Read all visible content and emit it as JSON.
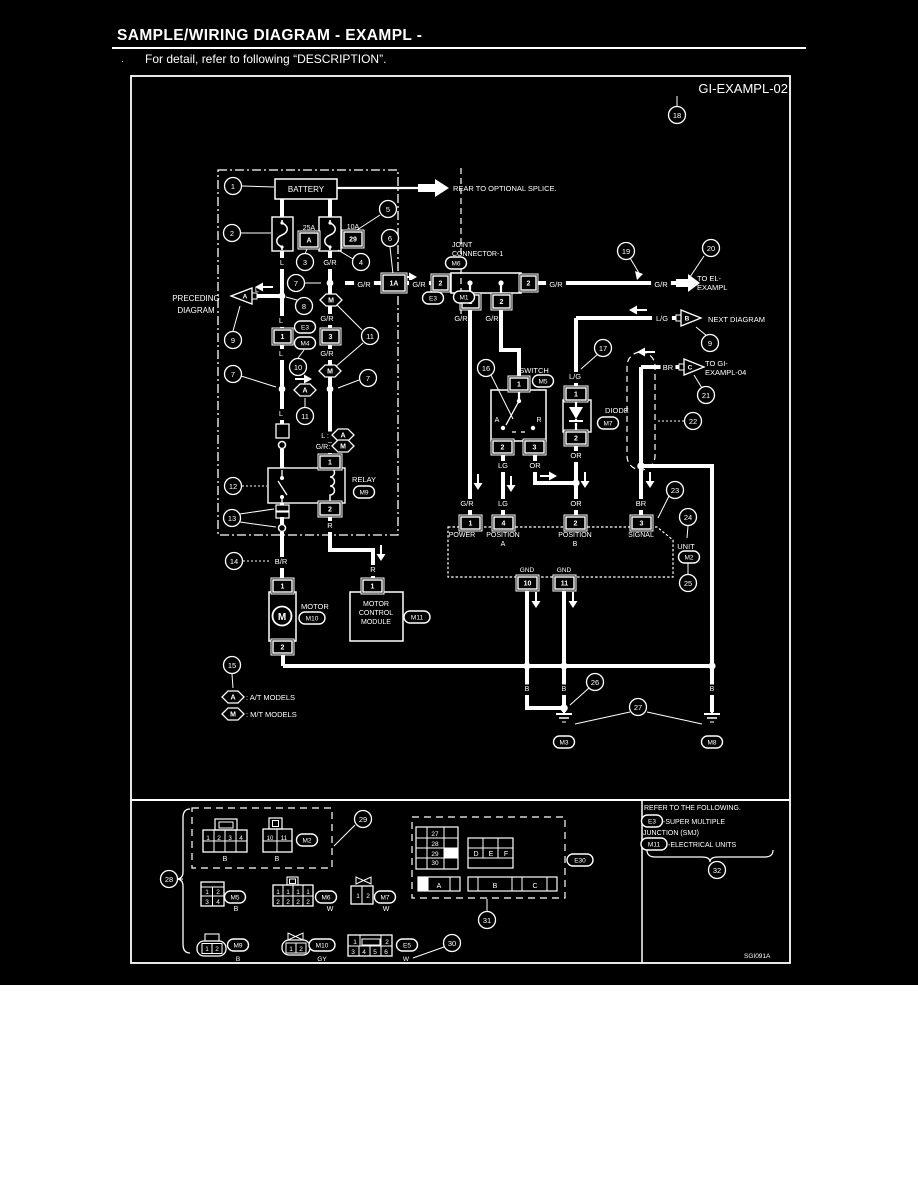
{
  "page": {
    "title": "SAMPLE/WIRING DIAGRAM - EXAMPL -",
    "bullet": "·",
    "subtitle": "For detail, refer to following “DESCRIPTION”.",
    "diagram_code": "GI-EXAMPL-02",
    "figure_code": "SGI091A"
  },
  "colors": {
    "background": "#000000",
    "foreground": "#ffffff"
  },
  "diagram": {
    "texts": [
      {
        "x": 788,
        "y": 93,
        "t": "GI-EXAMPL-02",
        "s": 13,
        "a": "e"
      },
      {
        "x": 306,
        "y": 192,
        "t": "BATTERY",
        "s": 8
      },
      {
        "x": 453,
        "y": 191,
        "t": "REAR TO OPTIONAL SPLICE.",
        "s": 7.5,
        "a": "s"
      },
      {
        "x": 309,
        "y": 230,
        "t": "25A",
        "s": 7
      },
      {
        "x": 353,
        "y": 229,
        "t": "10A",
        "s": 7
      },
      {
        "x": 282,
        "y": 265,
        "t": "L",
        "s": 7.5,
        "b": 1
      },
      {
        "x": 330,
        "y": 265,
        "t": "G/R",
        "s": 7.5,
        "b": 1
      },
      {
        "x": 364,
        "y": 287,
        "t": "G/R",
        "s": 7.5,
        "b": 1
      },
      {
        "x": 419,
        "y": 287,
        "t": "G/R",
        "s": 7.5,
        "b": 1
      },
      {
        "x": 556,
        "y": 287,
        "t": "G/R",
        "s": 7.5,
        "b": 1
      },
      {
        "x": 661,
        "y": 287,
        "t": "G/R",
        "s": 7.5,
        "b": 1
      },
      {
        "x": 257,
        "y": 292,
        "t": "L",
        "s": 7.5
      },
      {
        "x": 196,
        "y": 301,
        "t": "PRECEDING",
        "s": 8
      },
      {
        "x": 196,
        "y": 313,
        "t": "DIAGRAM",
        "s": 8
      },
      {
        "x": 452,
        "y": 247,
        "t": "JOINT",
        "s": 7,
        "a": "s"
      },
      {
        "x": 452,
        "y": 256,
        "t": "CONNECTOR-1",
        "s": 7,
        "a": "s"
      },
      {
        "x": 281,
        "y": 323,
        "t": "L",
        "s": 7.5,
        "b": 1
      },
      {
        "x": 327,
        "y": 321,
        "t": "G/R",
        "s": 7.5,
        "b": 1
      },
      {
        "x": 281,
        "y": 356,
        "t": "L",
        "s": 7.5,
        "b": 1
      },
      {
        "x": 327,
        "y": 356,
        "t": "G/R",
        "s": 7.5,
        "b": 1
      },
      {
        "x": 281,
        "y": 416,
        "t": "L",
        "s": 7.5,
        "b": 1
      },
      {
        "x": 461,
        "y": 321,
        "t": "G/R",
        "s": 7.5
      },
      {
        "x": 492,
        "y": 321,
        "t": "G/R",
        "s": 7.5
      },
      {
        "x": 534,
        "y": 373,
        "t": "SWITCH",
        "s": 7.5
      },
      {
        "x": 497,
        "y": 422,
        "t": "A",
        "s": 7
      },
      {
        "x": 539,
        "y": 422,
        "t": "R",
        "s": 7
      },
      {
        "x": 503,
        "y": 468,
        "t": "LG",
        "s": 7.5,
        "b": 1
      },
      {
        "x": 535,
        "y": 468,
        "t": "OR",
        "s": 7.5,
        "b": 1
      },
      {
        "x": 575,
        "y": 379,
        "t": "L/G",
        "s": 7.5,
        "b": 1
      },
      {
        "x": 605,
        "y": 413,
        "t": "DIODE",
        "s": 7.5,
        "a": "s"
      },
      {
        "x": 576,
        "y": 458,
        "t": "OR",
        "s": 7.5,
        "b": 1
      },
      {
        "x": 467,
        "y": 506,
        "t": "G/R",
        "s": 7.5,
        "b": 1
      },
      {
        "x": 503,
        "y": 506,
        "t": "LG",
        "s": 7.5,
        "b": 1
      },
      {
        "x": 576,
        "y": 506,
        "t": "OR",
        "s": 7.5,
        "b": 1
      },
      {
        "x": 641,
        "y": 506,
        "t": "BR",
        "s": 7.5,
        "b": 1
      },
      {
        "x": 662,
        "y": 321,
        "t": "L/G",
        "s": 7.5,
        "b": 1
      },
      {
        "x": 668,
        "y": 370,
        "t": "BR",
        "s": 7.5,
        "b": 1
      },
      {
        "x": 708,
        "y": 322,
        "t": "NEXT DIAGRAM",
        "s": 7.5,
        "a": "s"
      },
      {
        "x": 697,
        "y": 281,
        "t": "TO EL-",
        "s": 7.5,
        "a": "s"
      },
      {
        "x": 697,
        "y": 290,
        "t": "EXAMPL",
        "s": 7.5,
        "a": "s"
      },
      {
        "x": 705,
        "y": 366,
        "t": "TO GI-",
        "s": 7.5,
        "a": "s"
      },
      {
        "x": 705,
        "y": 375,
        "t": "EXAMPL-04",
        "s": 7.5,
        "a": "s"
      },
      {
        "x": 462,
        "y": 537,
        "t": "POWER",
        "s": 7
      },
      {
        "x": 503,
        "y": 537,
        "t": "POSITION",
        "s": 7
      },
      {
        "x": 503,
        "y": 546,
        "t": "A",
        "s": 7
      },
      {
        "x": 575,
        "y": 537,
        "t": "POSITION",
        "s": 7
      },
      {
        "x": 575,
        "y": 546,
        "t": "B",
        "s": 7
      },
      {
        "x": 641,
        "y": 537,
        "t": "SIGNAL",
        "s": 7
      },
      {
        "x": 527,
        "y": 572,
        "t": "GND",
        "s": 6.5
      },
      {
        "x": 564,
        "y": 572,
        "t": "GND",
        "s": 6.5
      },
      {
        "x": 686,
        "y": 549,
        "t": "UNIT",
        "s": 7.5
      },
      {
        "x": 352,
        "y": 482,
        "t": "RELAY",
        "s": 7.5,
        "a": "s"
      },
      {
        "x": 325,
        "y": 438,
        "t": "L :",
        "s": 7,
        "b": 1
      },
      {
        "x": 323,
        "y": 449,
        "t": "G/R:",
        "s": 7,
        "b": 1
      },
      {
        "x": 330,
        "y": 528,
        "t": "R",
        "s": 7.5,
        "b": 1
      },
      {
        "x": 373,
        "y": 572,
        "t": "R",
        "s": 7.5,
        "b": 1
      },
      {
        "x": 281,
        "y": 564,
        "t": "B/R",
        "s": 7.5,
        "b": 1
      },
      {
        "x": 301,
        "y": 609,
        "t": "MOTOR",
        "s": 7.5,
        "a": "s"
      },
      {
        "x": 376,
        "y": 606,
        "t": "MOTOR",
        "s": 7
      },
      {
        "x": 376,
        "y": 615,
        "t": "CONTROL",
        "s": 7
      },
      {
        "x": 376,
        "y": 624,
        "t": "MODULE",
        "s": 7
      },
      {
        "x": 246,
        "y": 700,
        "t": ": A/T MODELS",
        "s": 7.5,
        "a": "s"
      },
      {
        "x": 246,
        "y": 717,
        "t": ": M/T MODELS",
        "s": 7.5,
        "a": "s"
      },
      {
        "x": 527,
        "y": 691,
        "t": "B",
        "s": 7,
        "b": 1
      },
      {
        "x": 564,
        "y": 691,
        "t": "B",
        "s": 7,
        "b": 1
      },
      {
        "x": 712,
        "y": 691,
        "t": "B",
        "s": 7,
        "b": 1
      },
      {
        "x": 644,
        "y": 810,
        "t": "REFER TO THE FOLLOWING.",
        "s": 7,
        "a": "s"
      },
      {
        "x": 663,
        "y": 824,
        "t": "-SUPER MULTIPLE",
        "s": 7,
        "a": "s"
      },
      {
        "x": 643,
        "y": 835,
        "t": "JUNCTION (SMJ)",
        "s": 7,
        "a": "s"
      },
      {
        "x": 668,
        "y": 847,
        "t": "-ELECTRICAL UNITS",
        "s": 7,
        "a": "s"
      },
      {
        "x": 744,
        "y": 958,
        "t": "SGI091A",
        "s": 6.5,
        "a": "s"
      },
      {
        "x": 225,
        "y": 861,
        "t": "B",
        "s": 7
      },
      {
        "x": 277,
        "y": 861,
        "t": "B",
        "s": 7
      },
      {
        "x": 236,
        "y": 911,
        "t": "B",
        "s": 7
      },
      {
        "x": 330,
        "y": 911,
        "t": "W",
        "s": 7
      },
      {
        "x": 386,
        "y": 911,
        "t": "W",
        "s": 7
      },
      {
        "x": 238,
        "y": 961,
        "t": "B",
        "s": 6.5
      },
      {
        "x": 322,
        "y": 961,
        "t": "GY",
        "s": 6.5
      },
      {
        "x": 406,
        "y": 961,
        "t": "W",
        "s": 6.5
      },
      {
        "x": 208,
        "y": 840,
        "t": "1",
        "s": 6.5
      },
      {
        "x": 219,
        "y": 840,
        "t": "2",
        "s": 6.5
      },
      {
        "x": 230,
        "y": 840,
        "t": "3",
        "s": 6.5
      },
      {
        "x": 241,
        "y": 840,
        "t": "4",
        "s": 6.5
      },
      {
        "x": 270,
        "y": 840,
        "t": "10",
        "s": 6
      },
      {
        "x": 284,
        "y": 840,
        "t": "11",
        "s": 6
      },
      {
        "x": 207,
        "y": 894,
        "t": "1",
        "s": 6.5
      },
      {
        "x": 218,
        "y": 894,
        "t": "2",
        "s": 6.5
      },
      {
        "x": 207,
        "y": 904,
        "t": "3",
        "s": 6.5
      },
      {
        "x": 218,
        "y": 904,
        "t": "4",
        "s": 6.5
      },
      {
        "x": 278,
        "y": 894,
        "t": "1",
        "s": 6.5
      },
      {
        "x": 288,
        "y": 894,
        "t": "1",
        "s": 6.5
      },
      {
        "x": 298,
        "y": 894,
        "t": "1",
        "s": 6.5
      },
      {
        "x": 308,
        "y": 894,
        "t": "1",
        "s": 6.5
      },
      {
        "x": 278,
        "y": 904,
        "t": "2",
        "s": 6.5
      },
      {
        "x": 288,
        "y": 904,
        "t": "2",
        "s": 6.5
      },
      {
        "x": 298,
        "y": 904,
        "t": "2",
        "s": 6.5
      },
      {
        "x": 308,
        "y": 904,
        "t": "2",
        "s": 6.5
      },
      {
        "x": 358,
        "y": 898,
        "t": "1",
        "s": 6.5
      },
      {
        "x": 368,
        "y": 898,
        "t": "2",
        "s": 6.5
      },
      {
        "x": 207,
        "y": 951,
        "t": "1",
        "s": 6.5
      },
      {
        "x": 217,
        "y": 951,
        "t": "2",
        "s": 6.5
      },
      {
        "x": 291,
        "y": 951,
        "t": "1",
        "s": 6.5
      },
      {
        "x": 301,
        "y": 951,
        "t": "2",
        "s": 6.5
      },
      {
        "x": 355,
        "y": 944,
        "t": "1",
        "s": 6.5
      },
      {
        "x": 387,
        "y": 944,
        "t": "2",
        "s": 6.5
      },
      {
        "x": 353,
        "y": 954,
        "t": "3",
        "s": 6.5
      },
      {
        "x": 364,
        "y": 954,
        "t": "4",
        "s": 6.5
      },
      {
        "x": 375,
        "y": 954,
        "t": "5",
        "s": 6.5
      },
      {
        "x": 386,
        "y": 954,
        "t": "6",
        "s": 6.5
      },
      {
        "x": 435,
        "y": 836,
        "t": "27",
        "s": 6.5
      },
      {
        "x": 435,
        "y": 846,
        "t": "28",
        "s": 6.5
      },
      {
        "x": 435,
        "y": 856,
        "t": "29",
        "s": 6.5
      },
      {
        "x": 435,
        "y": 865,
        "t": "30",
        "s": 6.5
      },
      {
        "x": 476,
        "y": 856,
        "t": "D",
        "s": 7
      },
      {
        "x": 491,
        "y": 856,
        "t": "E",
        "s": 7
      },
      {
        "x": 506,
        "y": 856,
        "t": "F",
        "s": 7
      },
      {
        "x": 439,
        "y": 888,
        "t": "A",
        "s": 7
      },
      {
        "x": 495,
        "y": 888,
        "t": "B",
        "s": 7
      },
      {
        "x": 535,
        "y": 888,
        "t": "C",
        "s": 7
      }
    ],
    "pins": [
      {
        "x": 300,
        "y": 233,
        "w": 18,
        "h": 14,
        "t": "A"
      },
      {
        "x": 344,
        "y": 232,
        "w": 18,
        "h": 14,
        "t": "29"
      },
      {
        "x": 383,
        "y": 275,
        "w": 22,
        "h": 16,
        "t": "1A"
      },
      {
        "x": 433,
        "y": 276,
        "w": 15,
        "h": 14,
        "t": "2"
      },
      {
        "x": 521,
        "y": 276,
        "w": 15,
        "h": 14,
        "t": "2"
      },
      {
        "x": 462,
        "y": 295,
        "w": 17,
        "h": 13,
        "t": "2"
      },
      {
        "x": 493,
        "y": 295,
        "w": 17,
        "h": 13,
        "t": "2"
      },
      {
        "x": 274,
        "y": 330,
        "w": 17,
        "h": 13,
        "t": "1"
      },
      {
        "x": 322,
        "y": 330,
        "w": 17,
        "h": 13,
        "t": "3"
      },
      {
        "x": 510,
        "y": 378,
        "w": 18,
        "h": 12,
        "t": "1"
      },
      {
        "x": 493,
        "y": 441,
        "w": 19,
        "h": 12,
        "t": "2"
      },
      {
        "x": 525,
        "y": 441,
        "w": 19,
        "h": 12,
        "t": "3"
      },
      {
        "x": 566,
        "y": 388,
        "w": 20,
        "h": 12,
        "t": "1"
      },
      {
        "x": 566,
        "y": 432,
        "w": 20,
        "h": 12,
        "t": "2"
      },
      {
        "x": 320,
        "y": 456,
        "w": 20,
        "h": 12,
        "t": "1"
      },
      {
        "x": 320,
        "y": 503,
        "w": 20,
        "h": 12,
        "t": "2"
      },
      {
        "x": 273,
        "y": 580,
        "w": 19,
        "h": 12,
        "t": "1"
      },
      {
        "x": 273,
        "y": 641,
        "w": 19,
        "h": 12,
        "t": "2"
      },
      {
        "x": 363,
        "y": 580,
        "w": 19,
        "h": 12,
        "t": "1"
      },
      {
        "x": 461,
        "y": 517,
        "w": 19,
        "h": 12,
        "t": "1"
      },
      {
        "x": 494,
        "y": 517,
        "w": 19,
        "h": 12,
        "t": "4"
      },
      {
        "x": 566,
        "y": 517,
        "w": 19,
        "h": 12,
        "t": "2"
      },
      {
        "x": 632,
        "y": 517,
        "w": 19,
        "h": 12,
        "t": "3"
      },
      {
        "x": 518,
        "y": 577,
        "w": 19,
        "h": 12,
        "t": "10"
      },
      {
        "x": 555,
        "y": 577,
        "w": 19,
        "h": 12,
        "t": "11"
      }
    ],
    "callouts": [
      {
        "x": 233,
        "y": 186,
        "n": "1"
      },
      {
        "x": 232,
        "y": 233,
        "n": "2"
      },
      {
        "x": 305,
        "y": 262,
        "n": "3"
      },
      {
        "x": 361,
        "y": 262,
        "n": "4"
      },
      {
        "x": 388,
        "y": 209,
        "n": "5"
      },
      {
        "x": 390,
        "y": 238,
        "n": "6"
      },
      {
        "x": 296,
        "y": 283,
        "n": "7"
      },
      {
        "x": 304,
        "y": 306,
        "n": "8"
      },
      {
        "x": 233,
        "y": 340,
        "n": "9"
      },
      {
        "x": 298,
        "y": 367,
        "n": "10"
      },
      {
        "x": 370,
        "y": 336,
        "n": "11"
      },
      {
        "x": 233,
        "y": 374,
        "n": "7"
      },
      {
        "x": 368,
        "y": 378,
        "n": "7"
      },
      {
        "x": 305,
        "y": 416,
        "n": "11"
      },
      {
        "x": 233,
        "y": 486,
        "n": "12"
      },
      {
        "x": 232,
        "y": 518,
        "n": "13"
      },
      {
        "x": 234,
        "y": 561,
        "n": "14"
      },
      {
        "x": 232,
        "y": 665,
        "n": "15"
      },
      {
        "x": 486,
        "y": 368,
        "n": "16"
      },
      {
        "x": 603,
        "y": 348,
        "n": "17"
      },
      {
        "x": 677,
        "y": 115,
        "n": "18"
      },
      {
        "x": 626,
        "y": 251,
        "n": "19"
      },
      {
        "x": 711,
        "y": 248,
        "n": "20"
      },
      {
        "x": 710,
        "y": 343,
        "n": "9"
      },
      {
        "x": 706,
        "y": 395,
        "n": "21"
      },
      {
        "x": 693,
        "y": 421,
        "n": "22"
      },
      {
        "x": 675,
        "y": 490,
        "n": "23"
      },
      {
        "x": 688,
        "y": 517,
        "n": "24"
      },
      {
        "x": 688,
        "y": 583,
        "n": "25"
      },
      {
        "x": 595,
        "y": 682,
        "n": "26"
      },
      {
        "x": 638,
        "y": 707,
        "n": "27"
      },
      {
        "x": 169,
        "y": 879,
        "n": "28"
      },
      {
        "x": 363,
        "y": 819,
        "n": "29"
      },
      {
        "x": 452,
        "y": 943,
        "n": "30"
      },
      {
        "x": 487,
        "y": 920,
        "n": "31"
      },
      {
        "x": 717,
        "y": 870,
        "n": "32"
      }
    ],
    "ovals": [
      {
        "x": 456,
        "y": 263,
        "t": "M6"
      },
      {
        "x": 433,
        "y": 298,
        "t": "E3"
      },
      {
        "x": 464,
        "y": 297,
        "t": "M1"
      },
      {
        "x": 305,
        "y": 327,
        "t": "E3"
      },
      {
        "x": 305,
        "y": 343,
        "t": "M4"
      },
      {
        "x": 543,
        "y": 381,
        "t": "M5"
      },
      {
        "x": 608,
        "y": 423,
        "t": "M7"
      },
      {
        "x": 364,
        "y": 492,
        "t": "M9"
      },
      {
        "x": 689,
        "y": 557,
        "t": "M2"
      },
      {
        "x": 312,
        "y": 618,
        "t": "M10"
      },
      {
        "x": 417,
        "y": 617,
        "t": "M11"
      },
      {
        "x": 564,
        "y": 742,
        "t": "M3"
      },
      {
        "x": 712,
        "y": 742,
        "t": "M8"
      },
      {
        "x": 307,
        "y": 840,
        "t": "M2"
      },
      {
        "x": 235,
        "y": 897,
        "t": "M5"
      },
      {
        "x": 326,
        "y": 897,
        "t": "M6"
      },
      {
        "x": 385,
        "y": 897,
        "t": "M7"
      },
      {
        "x": 238,
        "y": 945,
        "t": "M9"
      },
      {
        "x": 322,
        "y": 945,
        "t": "M10"
      },
      {
        "x": 407,
        "y": 945,
        "t": "E5"
      },
      {
        "x": 580,
        "y": 860,
        "t": "E30"
      },
      {
        "x": 652,
        "y": 821,
        "t": "E3"
      },
      {
        "x": 654,
        "y": 844,
        "t": "M11"
      }
    ],
    "diamonds": [
      {
        "x": 331,
        "y": 300,
        "t": "M"
      },
      {
        "x": 330,
        "y": 371,
        "t": "M"
      },
      {
        "x": 305,
        "y": 390,
        "t": "A"
      },
      {
        "x": 343,
        "y": 435,
        "t": "A"
      },
      {
        "x": 343,
        "y": 446,
        "t": "M"
      },
      {
        "x": 233,
        "y": 697,
        "t": "A"
      },
      {
        "x": 233,
        "y": 714,
        "t": "M"
      }
    ],
    "triangles": [
      {
        "x": 231,
        "y": 296,
        "t": "A",
        "dir": "l"
      },
      {
        "x": 681,
        "y": 318,
        "t": "B",
        "dir": "r"
      },
      {
        "x": 684,
        "y": 367,
        "t": "C",
        "dir": "r"
      }
    ]
  }
}
